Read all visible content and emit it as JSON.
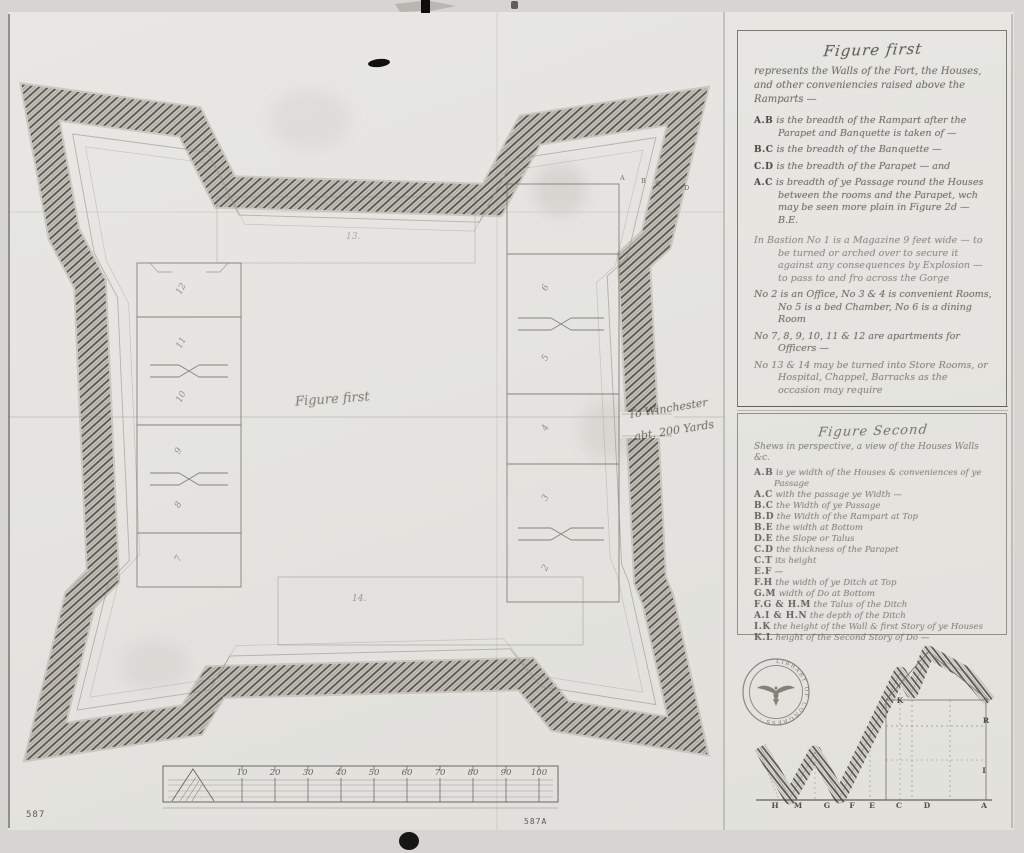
{
  "figure_first_panel": {
    "title": "Figure first",
    "intro": "represents the Walls of the Fort, the Houses, and other conveniencies raised above the Ramparts —",
    "items": [
      {
        "key": "A.B",
        "text": "is the breadth of the Rampart after the Parapet and Banquette is taken of —"
      },
      {
        "key": "B.C",
        "text": "is the breadth of the Banquette —"
      },
      {
        "key": "C.D",
        "text": "is the breadth of the Parapet — and"
      },
      {
        "key": "A.C",
        "text": "is breadth of ye Passage round the Houses between the rooms and the Parapet, wch may be seen more plain in Figure 2d — B.E."
      },
      {
        "key": "",
        "text": "In Bastion No 1 is a Magazine 9 feet wide — to be turned or arched over to secure it against any consequences by Explosion — to pass to and fro across the Gorge"
      },
      {
        "key": "",
        "text": "No 2 is an Office, No 3 & 4 is convenient Rooms, No 5 is a bed Chamber, No 6 is a dining Room"
      },
      {
        "key": "",
        "text": "No 7, 8, 9, 10, 11 & 12 are apartments for Officers —"
      },
      {
        "key": "",
        "text": "No 13 & 14 may be turned into Store Rooms, or Hospital, Chappel, Barracks as the occasion may require"
      }
    ]
  },
  "figure_second_panel": {
    "title": "Figure Second",
    "intro": "Shews in perspective, a view of the Houses Walls &c.",
    "items": [
      {
        "key": "A.B",
        "text": "is ye width of the Houses & conveniences of ye Passage"
      },
      {
        "key": "A.C",
        "text": "with the passage ye Width —"
      },
      {
        "key": "B.C",
        "text": "the Width of ye Passage"
      },
      {
        "key": "B.D",
        "text": "the Width of the Rampart at Top"
      },
      {
        "key": "B.E",
        "text": "the width at Bottom"
      },
      {
        "key": "D.E",
        "text": "the Slope or Talus"
      },
      {
        "key": "C.D",
        "text": "the thickness of the Parapet"
      },
      {
        "key": "C.T",
        "text": "its height"
      },
      {
        "key": "E.F",
        "text": "—"
      },
      {
        "key": "F.H",
        "text": "the width of ye Ditch at Top"
      },
      {
        "key": "G.M",
        "text": "width of Do at Bottom"
      },
      {
        "key": "F.G & H.M",
        "text": "the Talus of the Ditch"
      },
      {
        "key": "A.I & H.N",
        "text": "the depth of the Ditch"
      },
      {
        "key": "I.K",
        "text": "the height of the Wall & first Story of ye Houses"
      },
      {
        "key": "K.L",
        "text": "height of the Second Story of Do —"
      }
    ]
  },
  "plan": {
    "center_label": "Figure first",
    "winchester_line1": "To Winchester",
    "winchester_line2": "abt. 200 Yards",
    "corner_letters": [
      "A",
      "B",
      "C",
      "D"
    ],
    "left_rooms": [
      "12",
      "11",
      "10",
      "9",
      "8",
      "7"
    ],
    "right_rooms": [
      "6",
      "5",
      "4",
      "3",
      "2"
    ],
    "building_13": "13.",
    "building_14": "14.",
    "scale_ticks": [
      "10",
      "20",
      "30",
      "40",
      "50",
      "60",
      "70",
      "80",
      "90",
      "100"
    ]
  },
  "profile": {
    "bottom_letters": [
      "H",
      "M",
      "G",
      "F",
      "E",
      "C",
      "D",
      "A"
    ],
    "right_letters": [
      "K",
      "R",
      "I"
    ]
  },
  "stamp": {
    "label": "LIBRARY OF CONGRESS · "
  },
  "page_numbers": {
    "left": "587",
    "bottom_center": "587A"
  }
}
